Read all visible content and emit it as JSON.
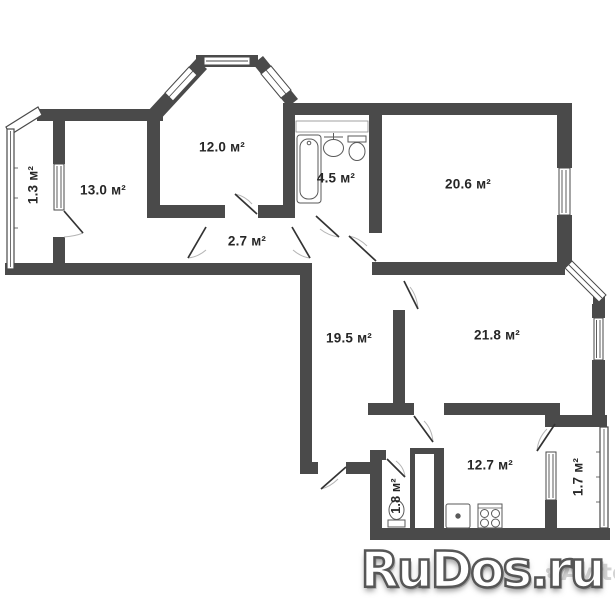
{
  "rooms": {
    "balcony_left": "1.3 м²",
    "bedroom_left": "13.0 м²",
    "bedroom_top": "12.0 м²",
    "bathroom": "4.5 м²",
    "living_room": "20.6 м²",
    "corridor": "2.7 м²",
    "hall": "19.5 м²",
    "bedroom_right": "21.8 м²",
    "kitchen": "12.7 м²",
    "wc": "1.8 м²",
    "balcony_bottom": "1.7 м²"
  },
  "watermark": {
    "site": "RuDos.ru",
    "secondary": "Avito"
  },
  "colors": {
    "wall": "#4a4a4a",
    "background": "#ffffff",
    "label": "#262626",
    "door_leaf": "#333333",
    "door_arc": "#b5b5b5",
    "watermark_fill": "#ffffff",
    "watermark_outline": "#565656"
  }
}
